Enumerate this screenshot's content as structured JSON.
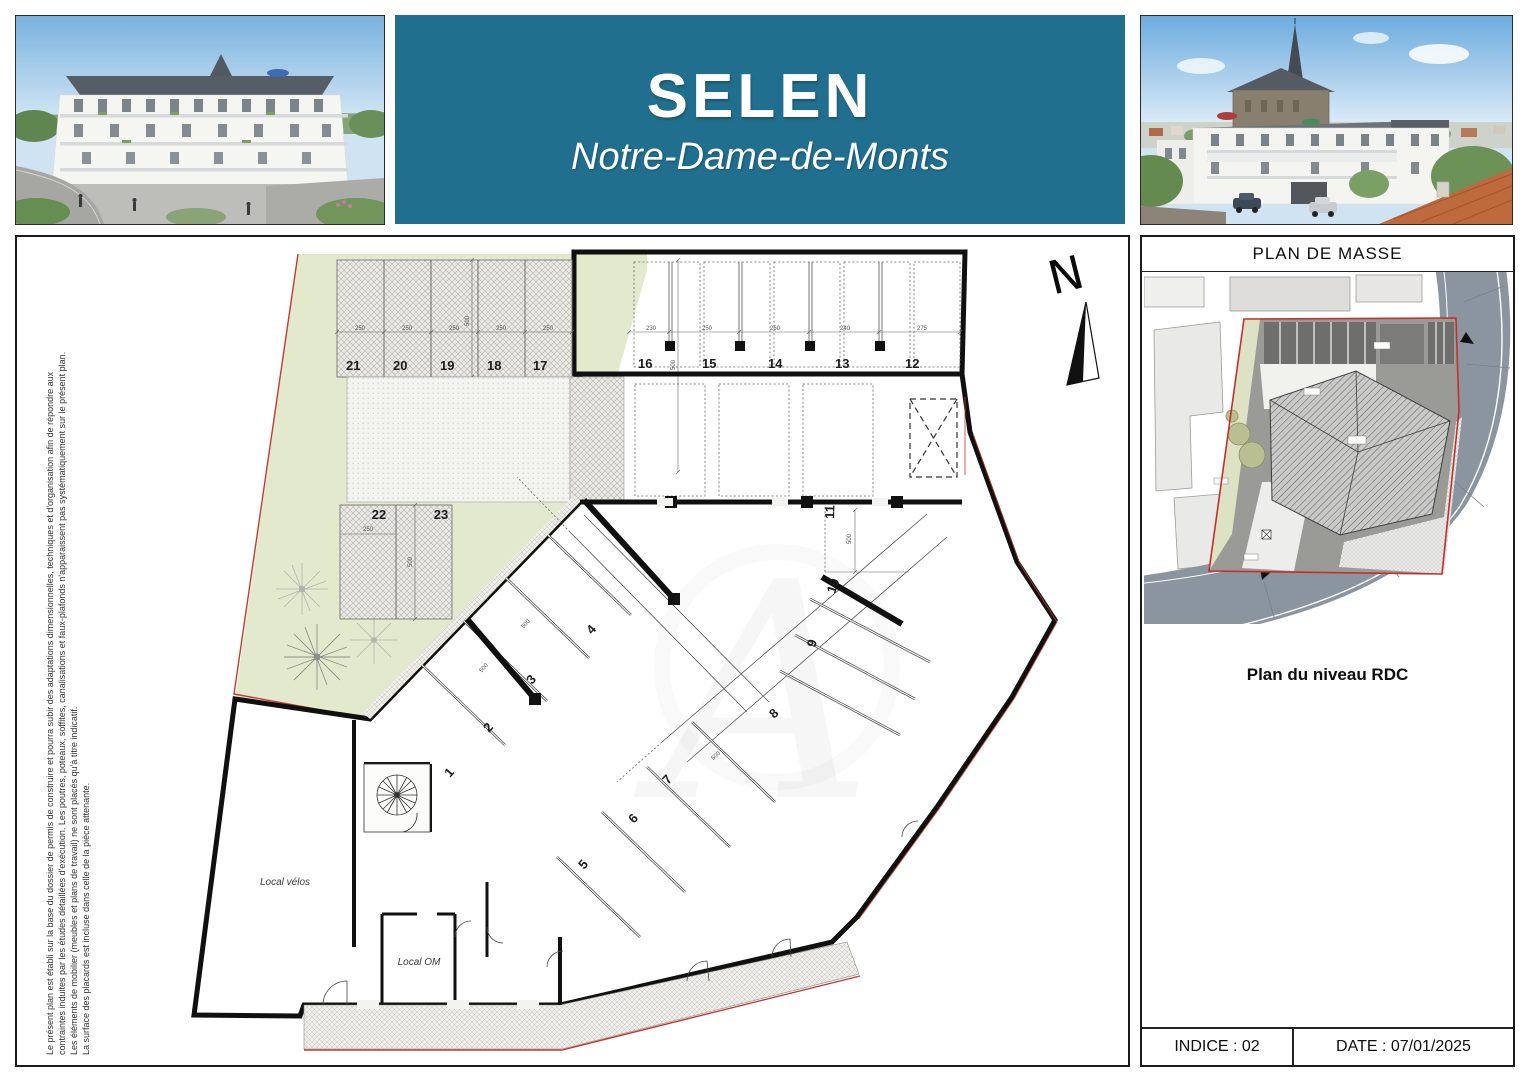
{
  "banner": {
    "title": "SELEN",
    "subtitle": "Notre-Dame-de-Monts",
    "bg_color": "#216f8e"
  },
  "disclaimer": {
    "line1": "Le présent plan est établi sur la base du dossier de permis de  construire et pourra subir des adaptations dimensionnelles, techniques et d'organisation afin de répondre aux",
    "line2": "contraintes induites par les études détaillées d'exécution. Les poutres, poteaux, soffites, canalisations et faux-plafonds n'apparaissent pas systématiquement sur le présent plan.",
    "line3": "Les éléments de mobilier (meubles et plans de travail) ne sont placés qu'à titre indicatif.",
    "line4": "La surface des placards est incluse dans celle de la pièce attenante."
  },
  "plan": {
    "north_label": "N",
    "watermark": "A",
    "local_velos": "Local vélos",
    "local_om": "Local OM",
    "interior_stalls": [
      "1",
      "2",
      "3",
      "4",
      "5",
      "6",
      "7",
      "8",
      "9",
      "10",
      "11"
    ],
    "top_right_stalls": [
      "16",
      "15",
      "14",
      "13",
      "12"
    ],
    "top_left_stalls": [
      "21",
      "20",
      "19",
      "18",
      "17"
    ],
    "mid_stalls": [
      "22",
      "23"
    ],
    "dims_top_right": [
      "230",
      "250",
      "260",
      "240",
      "275"
    ],
    "dims_top_left": [
      "250",
      "250",
      "250",
      "250",
      "250"
    ],
    "dim_500": "500",
    "dim_250": "250"
  },
  "sidebar": {
    "masse_title": "PLAN DE MASSE",
    "level_title": "Plan du niveau RDC",
    "indice_label": "INDICE : 02",
    "date_label": "DATE : 07/01/2025"
  }
}
